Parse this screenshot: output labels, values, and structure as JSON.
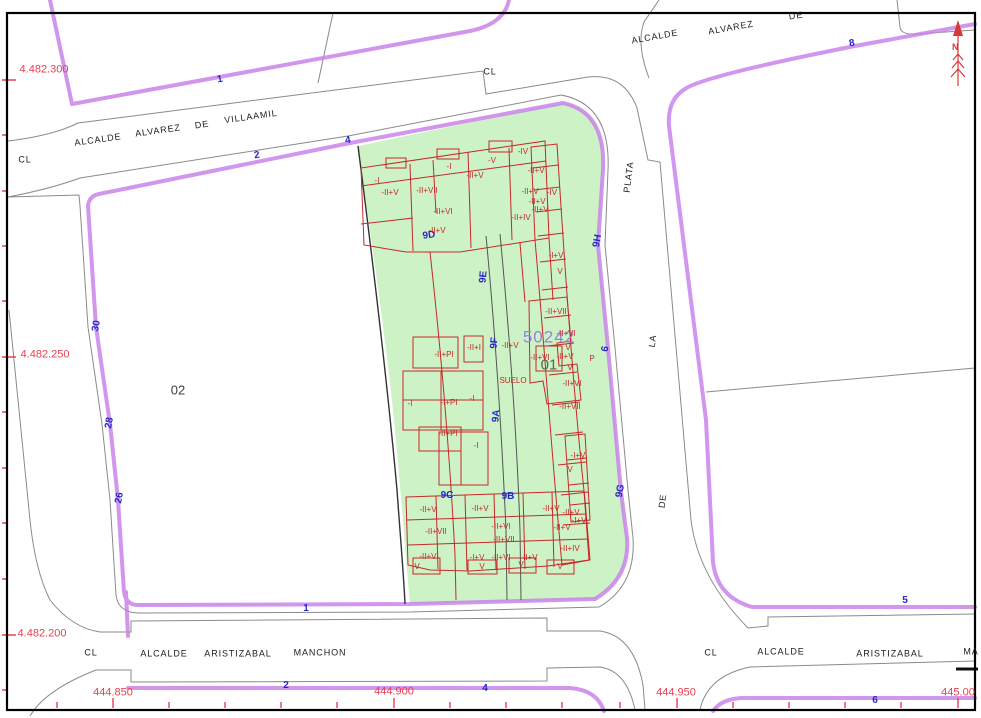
{
  "colors": {
    "block_outline": "#c77fe9",
    "parcel_fill": "#cdf2c6",
    "building_lines": "#c62828",
    "coordinate_red": "#e8404e",
    "portal_blue": "#2727c8",
    "parcel_number_purple": "#9484da",
    "street_gray": "#8a8a8a"
  },
  "north": {
    "label": "N"
  },
  "parcel": {
    "labels": [
      {
        "t": "50242",
        "x": 549,
        "y": 337,
        "r": 0,
        "cls": "pnum"
      },
      {
        "t": "01",
        "x": 549,
        "y": 365,
        "r": 0,
        "cls": "b01"
      },
      {
        "t": "02",
        "x": 178,
        "y": 390,
        "r": 0,
        "cls": "b02"
      }
    ]
  },
  "coordinates": [
    {
      "t": "4.482.300",
      "x": 44,
      "y": 70,
      "r": 0
    },
    {
      "t": "4.482.250",
      "x": 45,
      "y": 355,
      "r": 0
    },
    {
      "t": "4.482.200",
      "x": 42,
      "y": 634,
      "r": 0
    },
    {
      "t": "444.850",
      "x": 113,
      "y": 693,
      "r": 0
    },
    {
      "t": "444.900",
      "x": 394,
      "y": 692,
      "r": 0
    },
    {
      "t": "444.950",
      "x": 676,
      "y": 693,
      "r": 0
    },
    {
      "t": "445.00",
      "x": 958,
      "y": 693,
      "r": 0
    }
  ],
  "streets": [
    {
      "t": "CL",
      "x": 25,
      "y": 160,
      "r": 0
    },
    {
      "t": "ALCALDE",
      "x": 98,
      "y": 140,
      "r": -8
    },
    {
      "t": "ALVAREZ",
      "x": 158,
      "y": 131,
      "r": -8
    },
    {
      "t": "DE",
      "x": 202,
      "y": 125,
      "r": -8
    },
    {
      "t": "VILLAAMIL",
      "x": 251,
      "y": 117,
      "r": -8
    },
    {
      "t": "CL",
      "x": 490,
      "y": 72,
      "r": 0
    },
    {
      "t": "ALCALDE",
      "x": 655,
      "y": 37,
      "r": -10
    },
    {
      "t": "ALVAREZ",
      "x": 731,
      "y": 28,
      "r": -10
    },
    {
      "t": "DE",
      "x": 796,
      "y": 16,
      "r": -8
    },
    {
      "t": "PLATA",
      "x": 629,
      "y": 177,
      "r": -83
    },
    {
      "t": "LA",
      "x": 653,
      "y": 341,
      "r": -83
    },
    {
      "t": "DE",
      "x": 663,
      "y": 501,
      "r": -83
    },
    {
      "t": "CL",
      "x": 91,
      "y": 653,
      "r": 0
    },
    {
      "t": "ALCALDE",
      "x": 164,
      "y": 654,
      "r": 0
    },
    {
      "t": "ARISTIZABAL",
      "x": 238,
      "y": 654,
      "r": 0
    },
    {
      "t": "MANCHON",
      "x": 320,
      "y": 653,
      "r": 0
    },
    {
      "t": "CL",
      "x": 711,
      "y": 653,
      "r": 0
    },
    {
      "t": "ALCALDE",
      "x": 781,
      "y": 652,
      "r": 0
    },
    {
      "t": "ARISTIZABAL",
      "x": 890,
      "y": 654,
      "r": 0
    },
    {
      "t": "MA",
      "x": 971,
      "y": 652,
      "r": 0
    }
  ],
  "house_numbers": [
    {
      "t": "1",
      "x": 220,
      "y": 80,
      "r": -10
    },
    {
      "t": "2",
      "x": 257,
      "y": 156,
      "r": -8
    },
    {
      "t": "4",
      "x": 348,
      "y": 141,
      "r": -8
    },
    {
      "t": "30",
      "x": 97,
      "y": 326,
      "r": -80
    },
    {
      "t": "28",
      "x": 110,
      "y": 423,
      "r": -80
    },
    {
      "t": "26",
      "x": 120,
      "y": 498,
      "r": -80
    },
    {
      "t": "1",
      "x": 306,
      "y": 609,
      "r": 0
    },
    {
      "t": "2",
      "x": 286,
      "y": 686,
      "r": 0
    },
    {
      "t": "4",
      "x": 485,
      "y": 689,
      "r": 0
    },
    {
      "t": "8",
      "x": 852,
      "y": 44,
      "r": -10
    },
    {
      "t": "5",
      "x": 905,
      "y": 601,
      "r": 0
    },
    {
      "t": "6",
      "x": 875,
      "y": 701,
      "r": 0
    },
    {
      "t": "9D",
      "x": 429,
      "y": 236,
      "r": -8
    },
    {
      "t": "9E",
      "x": 484,
      "y": 277,
      "r": -85
    },
    {
      "t": "9F",
      "x": 495,
      "y": 343,
      "r": -85
    },
    {
      "t": "9A",
      "x": 497,
      "y": 416,
      "r": -85
    },
    {
      "t": "9C",
      "x": 447,
      "y": 496,
      "r": 0
    },
    {
      "t": "9B",
      "x": 508,
      "y": 497,
      "r": 0
    },
    {
      "t": "9H",
      "x": 598,
      "y": 241,
      "r": -80
    },
    {
      "t": "6",
      "x": 606,
      "y": 349,
      "r": -80
    },
    {
      "t": "9G",
      "x": 621,
      "y": 491,
      "r": -80
    }
  ],
  "building_heights": [
    {
      "t": "-I",
      "x": 377,
      "y": 181
    },
    {
      "t": "-II+V",
      "x": 390,
      "y": 193
    },
    {
      "t": "-II+VII",
      "x": 427,
      "y": 191
    },
    {
      "t": "-I",
      "x": 449,
      "y": 167
    },
    {
      "t": "-II+V",
      "x": 475,
      "y": 176
    },
    {
      "t": "-V",
      "x": 492,
      "y": 161
    },
    {
      "t": "-IV",
      "x": 523,
      "y": 152
    },
    {
      "t": "-II+V",
      "x": 536,
      "y": 171
    },
    {
      "t": "-II+VI",
      "x": 443,
      "y": 212
    },
    {
      "t": "-II+V",
      "x": 437,
      "y": 231
    },
    {
      "t": "-II+V",
      "x": 530,
      "y": 192
    },
    {
      "t": "-IV",
      "x": 552,
      "y": 193
    },
    {
      "t": "-II+V",
      "x": 537,
      "y": 202
    },
    {
      "t": "-II+V",
      "x": 540,
      "y": 210
    },
    {
      "t": "-II+IV",
      "x": 521,
      "y": 218
    },
    {
      "t": "-I+V",
      "x": 556,
      "y": 256
    },
    {
      "t": "V",
      "x": 560,
      "y": 272
    },
    {
      "t": "-II+VII",
      "x": 556,
      "y": 312
    },
    {
      "t": "-II+VI",
      "x": 566,
      "y": 334
    },
    {
      "t": "-II+V",
      "x": 510,
      "y": 346
    },
    {
      "t": "-II+I",
      "x": 474,
      "y": 348
    },
    {
      "t": "-II+PI",
      "x": 444,
      "y": 355
    },
    {
      "t": "-II+VI",
      "x": 540,
      "y": 358
    },
    {
      "t": "-II+V",
      "x": 565,
      "y": 357
    },
    {
      "t": "V",
      "x": 568,
      "y": 348
    },
    {
      "t": "V",
      "x": 570,
      "y": 368
    },
    {
      "t": "-II+VI",
      "x": 572,
      "y": 384
    },
    {
      "t": "-II+VII",
      "x": 570,
      "y": 407
    },
    {
      "t": "-I",
      "x": 410,
      "y": 404
    },
    {
      "t": "-I+PI",
      "x": 449,
      "y": 403
    },
    {
      "t": "-I",
      "x": 472,
      "y": 399
    },
    {
      "t": "-II+PI",
      "x": 448,
      "y": 434
    },
    {
      "t": "-I",
      "x": 476,
      "y": 446
    },
    {
      "t": "-I+V",
      "x": 578,
      "y": 456
    },
    {
      "t": "V",
      "x": 570,
      "y": 470
    },
    {
      "t": "-II+V",
      "x": 428,
      "y": 510
    },
    {
      "t": "-II+V",
      "x": 480,
      "y": 509
    },
    {
      "t": "-II+V",
      "x": 551,
      "y": 509
    },
    {
      "t": "-II+V",
      "x": 571,
      "y": 513
    },
    {
      "t": "-I+V",
      "x": 579,
      "y": 521
    },
    {
      "t": "-II+VI",
      "x": 501,
      "y": 527
    },
    {
      "t": "-II+V",
      "x": 562,
      "y": 528
    },
    {
      "t": "-II+VII",
      "x": 436,
      "y": 532
    },
    {
      "t": "-II+VII",
      "x": 504,
      "y": 540
    },
    {
      "t": "-II+IV",
      "x": 570,
      "y": 549
    },
    {
      "t": "-II+VI",
      "x": 429,
      "y": 557
    },
    {
      "t": "-I+V",
      "x": 477,
      "y": 558
    },
    {
      "t": "-II+VI",
      "x": 501,
      "y": 558
    },
    {
      "t": "-II+V",
      "x": 529,
      "y": 558
    },
    {
      "t": "V",
      "x": 417,
      "y": 567
    },
    {
      "t": "V",
      "x": 482,
      "y": 567
    },
    {
      "t": "V",
      "x": 521,
      "y": 565
    },
    {
      "t": "V",
      "x": 560,
      "y": 567
    },
    {
      "t": "SUELO",
      "x": 513,
      "y": 381
    },
    {
      "t": "P",
      "x": 592,
      "y": 359
    }
  ]
}
